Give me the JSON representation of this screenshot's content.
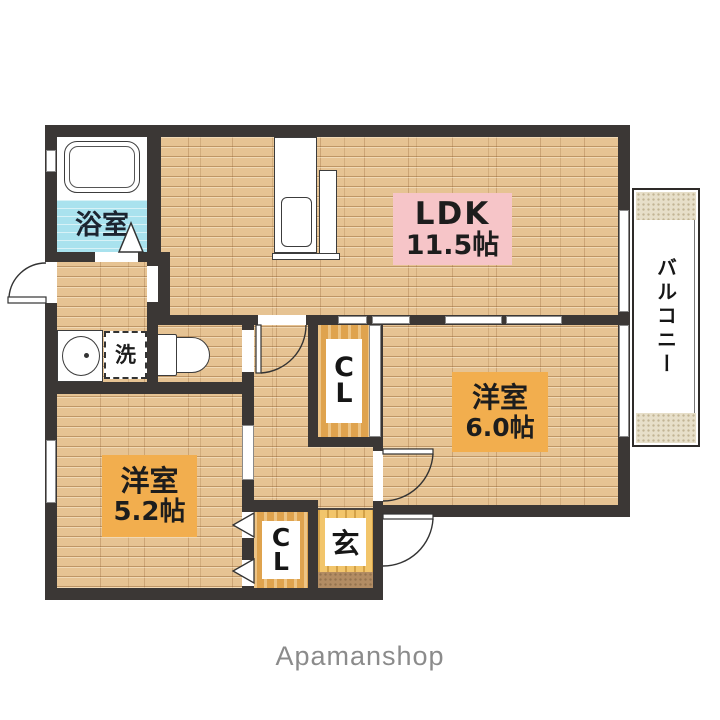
{
  "plan": {
    "watermark": "Apamanshop",
    "ldk": {
      "name": "LDK",
      "area": "11.5帖"
    },
    "western6": {
      "name": "洋室",
      "area": "6.0帖"
    },
    "western5": {
      "name": "洋室",
      "area": "5.2帖"
    },
    "bath": {
      "name": "浴室"
    },
    "balcony": {
      "name": "バルコニー"
    },
    "genkan": {
      "name": "玄"
    },
    "laundry": {
      "name": "洗"
    },
    "closet_mid": {
      "l1": "C",
      "l2": "L"
    },
    "closet_bottom": {
      "l1": "C",
      "l2": "L"
    }
  },
  "colors": {
    "wall": "#3b3735",
    "floor_wood": "#e6c393",
    "label_pink": "#f6c5c8",
    "label_orange": "#f2ae4e",
    "bath_cyan": "#a9e2ee",
    "genkan_yellow": "#f2c56b",
    "closet_orange": "#dfa34e",
    "step_brown": "#b28c63",
    "balcony_beige": "#e7dfc9",
    "watermark_gray": "#8b8b8b"
  }
}
